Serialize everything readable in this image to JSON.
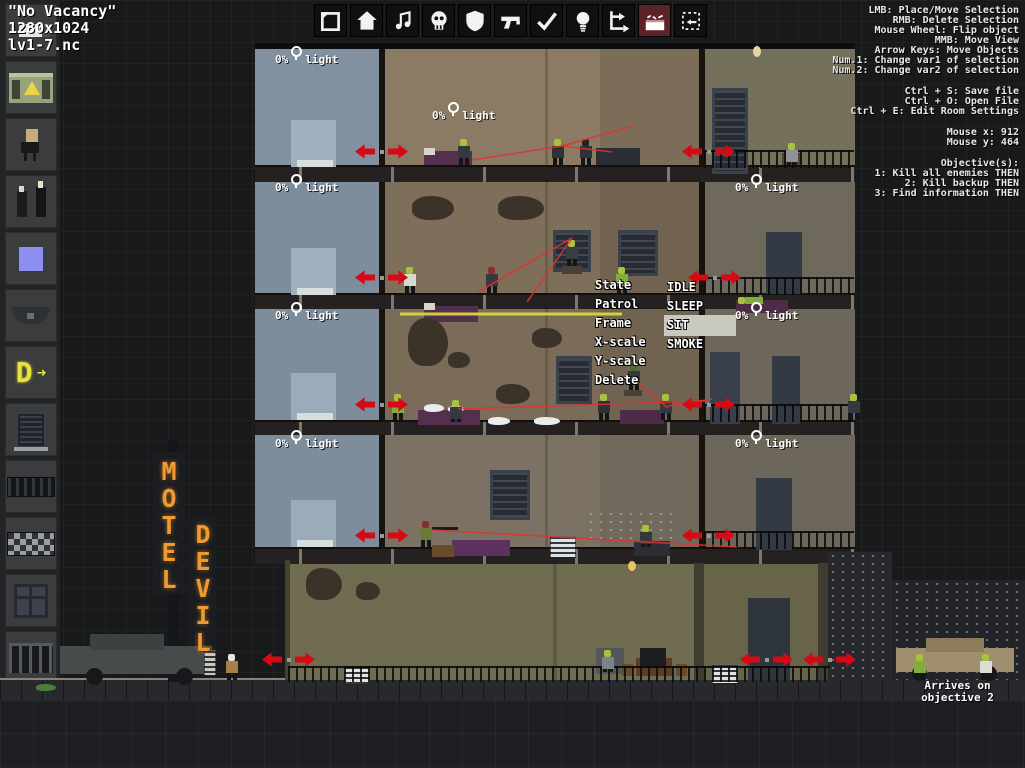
{
  "window": {
    "level_name": "\"No Vacancy\"",
    "resolution": "1280x1024",
    "filename": "lv1-7.nc"
  },
  "toolbar": {
    "selected_index": 9,
    "icons": [
      "selection-frame-icon",
      "house-icon",
      "music-note-icon",
      "skull-icon",
      "shield-icon",
      "gun-icon",
      "checkmark-icon",
      "lightbulb-icon",
      "route-icon",
      "bed-icon",
      "resize-region-icon"
    ]
  },
  "help_panel": {
    "controls": [
      "LMB: Place/Move Selection",
      "RMB: Delete Selection",
      "Mouse Wheel: Flip object",
      "MMB: Move View",
      "Arrow Keys: Move Objects",
      "Num.1: Change var1 of selection",
      "Num.2: Change var2 of selection"
    ],
    "file_commands": [
      "Ctrl + S: Save file",
      "Ctrl + O: Open File",
      "Ctrl + E: Edit Room Settings"
    ],
    "mouse_status": [
      "Mouse x: 912",
      "Mouse y: 464"
    ],
    "objectives": [
      "Objective(s):",
      "1: Kill all enemies THEN",
      "2: Kill backup THEN",
      "3: Find information THEN"
    ]
  },
  "context_menu": {
    "items": [
      "State",
      "Patrol",
      "Frame",
      "X-scale",
      "Y-scale",
      "Delete"
    ],
    "state_options": [
      "IDLE",
      "SLEEP",
      "SIT",
      "SMOKE"
    ],
    "highlighted_option": "SIT"
  },
  "sidebar": {
    "items": [
      "radiator-icon",
      "generator-icon",
      "enemy-figure-icon",
      "enemy-pair-icon",
      "blue-marker-icon",
      "awning-icon",
      "neon-letter-icon",
      "blinds-icon",
      "grill-icon",
      "checker-tiles-icon",
      "window-icon",
      "railing-icon",
      "planter-icon"
    ]
  },
  "sign": {
    "top_word": "MOTEL",
    "bottom_word": "DEVIL",
    "color": "#ef9a2e"
  },
  "street": {
    "arrival_note_line1": "Arrives on",
    "arrival_note_line2": "objective 2"
  },
  "light_label_text": "0% light",
  "colors": {
    "arrow_red": "#d60a14",
    "sight_red": "#e13232",
    "patrol_yellow": "#d8d838",
    "enemy_green": "#a6c23e",
    "neon_orange": "#ef9a2e",
    "toolbar_selected_bg": "#5b2327"
  },
  "scene": {
    "light_labels": [
      {
        "x": 275,
        "y": 46
      },
      {
        "x": 432,
        "y": 102
      },
      {
        "x": 275,
        "y": 174
      },
      {
        "x": 735,
        "y": 174
      },
      {
        "x": 275,
        "y": 302
      },
      {
        "x": 735,
        "y": 302
      },
      {
        "x": 275,
        "y": 430
      },
      {
        "x": 735,
        "y": 430
      }
    ],
    "door_arrow_pairs": [
      {
        "x": 355,
        "y": 143
      },
      {
        "x": 682,
        "y": 143
      },
      {
        "x": 355,
        "y": 269
      },
      {
        "x": 688,
        "y": 269
      },
      {
        "x": 355,
        "y": 396
      },
      {
        "x": 682,
        "y": 396
      },
      {
        "x": 355,
        "y": 527
      },
      {
        "x": 682,
        "y": 527
      },
      {
        "x": 262,
        "y": 651
      },
      {
        "x": 740,
        "y": 651
      },
      {
        "x": 803,
        "y": 651
      }
    ],
    "sight_lines": [
      [
        472,
        160,
        562,
        146
      ],
      [
        562,
        146,
        634,
        126
      ],
      [
        562,
        146,
        612,
        152
      ],
      [
        572,
        238,
        478,
        292
      ],
      [
        572,
        238,
        527,
        302
      ],
      [
        458,
        409,
        706,
        401
      ],
      [
        637,
        382,
        668,
        408
      ],
      [
        668,
        406,
        712,
        399
      ],
      [
        432,
        530,
        737,
        547
      ]
    ],
    "patrol_lines": [
      [
        400,
        314,
        622,
        314
      ]
    ],
    "enemies": [
      {
        "x": 458,
        "y": 139,
        "head": "#a6c23e",
        "body": "#34373b"
      },
      {
        "x": 552,
        "y": 139,
        "head": "#a6c23e",
        "body": "#2e3135"
      },
      {
        "x": 580,
        "y": 139,
        "head": "#1f2124",
        "body": "#2e3135"
      },
      {
        "x": 786,
        "y": 143,
        "head": "#a6c23e",
        "body": "#8d9298",
        "pose": "sit"
      },
      {
        "x": 404,
        "y": 267,
        "head": "#a6c23e",
        "body": "#d9d9d4"
      },
      {
        "x": 486,
        "y": 267,
        "head": "#8a2d2d",
        "body": "#35383c"
      },
      {
        "x": 566,
        "y": 240,
        "head": "#a6c23e",
        "body": "#3a3d41"
      },
      {
        "x": 616,
        "y": 267,
        "head": "#a6c23e",
        "body": "#7fae3c"
      },
      {
        "x": 738,
        "y": 296,
        "head": "#a6c23e",
        "body": "#7fae3c",
        "pose": "lie"
      },
      {
        "x": 392,
        "y": 394,
        "head": "#a6c23e",
        "body": "#7fae3c"
      },
      {
        "x": 450,
        "y": 400,
        "head": "#a6c23e",
        "body": "#35383c",
        "pose": "sit"
      },
      {
        "x": 598,
        "y": 394,
        "head": "#a6c23e",
        "body": "#2e3135"
      },
      {
        "x": 660,
        "y": 394,
        "head": "#a6c23e",
        "body": "#35383c"
      },
      {
        "x": 628,
        "y": 364,
        "head": "#4e6b2e",
        "body": "#35383c"
      },
      {
        "x": 848,
        "y": 394,
        "head": "#a6c23e",
        "body": "#35383c"
      },
      {
        "x": 420,
        "y": 521,
        "head": "#8a2d2d",
        "body": "#6b7a3a"
      },
      {
        "x": 640,
        "y": 525,
        "head": "#a6c23e",
        "body": "#34373b",
        "pose": "sit"
      },
      {
        "x": 602,
        "y": 650,
        "head": "#a6c23e",
        "body": "#7d8286",
        "pose": "sit"
      },
      {
        "x": 226,
        "y": 654,
        "head": "#e8e5dc",
        "body": "#a87e46"
      },
      {
        "x": 914,
        "y": 654,
        "head": "#a6c23e",
        "body": "#7fae3c"
      },
      {
        "x": 980,
        "y": 654,
        "head": "#a6c23e",
        "body": "#dcdcd6"
      }
    ],
    "props": [
      {
        "n": "roof-edge",
        "x": 255,
        "y": 43,
        "w": 600,
        "h": 6,
        "c": "#0c0d0e"
      },
      {
        "n": "room-seam",
        "x": 545,
        "y": 48,
        "w": 3,
        "h": 117,
        "c": "rgba(0,0,0,0.16)"
      },
      {
        "n": "room-shade",
        "x": 600,
        "y": 48,
        "w": 100,
        "h": 117,
        "c": "rgba(0,0,0,0.10)"
      },
      {
        "n": "room-seam",
        "x": 545,
        "y": 180,
        "w": 3,
        "h": 113,
        "c": "rgba(0,0,0,0.16)"
      },
      {
        "n": "room-shade",
        "x": 600,
        "y": 180,
        "w": 100,
        "h": 113,
        "c": "rgba(0,0,0,0.10)"
      },
      {
        "n": "room-seam",
        "x": 545,
        "y": 307,
        "w": 3,
        "h": 113,
        "c": "rgba(0,0,0,0.16)"
      },
      {
        "n": "room-shade",
        "x": 600,
        "y": 307,
        "w": 100,
        "h": 113,
        "c": "rgba(0,0,0,0.08)"
      },
      {
        "n": "room-seam",
        "x": 545,
        "y": 433,
        "w": 3,
        "h": 114,
        "c": "rgba(0,0,0,0.16)"
      },
      {
        "n": "room-shade",
        "x": 600,
        "y": 433,
        "w": 100,
        "h": 114,
        "c": "rgba(0,0,0,0.08)"
      },
      {
        "n": "ground-seam",
        "x": 553,
        "y": 562,
        "w": 4,
        "h": 118,
        "c": "rgba(0,0,0,0.15)"
      },
      {
        "n": "ground-left-wall",
        "x": 285,
        "y": 560,
        "w": 5,
        "h": 120,
        "c": "#45422f"
      },
      {
        "n": "elevator-panel",
        "x": 291,
        "y": 120,
        "w": 45,
        "h": 47,
        "c": "#9fb0bf"
      },
      {
        "n": "elevator-sill",
        "x": 297,
        "y": 160,
        "w": 36,
        "h": 7,
        "c": "#d8ddde"
      },
      {
        "n": "elevator-panel",
        "x": 291,
        "y": 248,
        "w": 45,
        "h": 47,
        "c": "#9fb0bf"
      },
      {
        "n": "elevator-sill",
        "x": 297,
        "y": 288,
        "w": 36,
        "h": 7,
        "c": "#d8ddde"
      },
      {
        "n": "elevator-panel",
        "x": 291,
        "y": 373,
        "w": 45,
        "h": 47,
        "c": "#9aabba"
      },
      {
        "n": "elevator-sill",
        "x": 297,
        "y": 413,
        "w": 36,
        "h": 7,
        "c": "#d8ddde"
      },
      {
        "n": "elevator-panel",
        "x": 291,
        "y": 500,
        "w": 45,
        "h": 47,
        "c": "#9aabba"
      },
      {
        "n": "elevator-sill",
        "x": 297,
        "y": 540,
        "w": 36,
        "h": 7,
        "c": "#d8ddde"
      },
      {
        "n": "bed",
        "x": 424,
        "y": 151,
        "w": 48,
        "h": 14,
        "c": "#55304e"
      },
      {
        "n": "pillow",
        "x": 424,
        "y": 148,
        "w": 11,
        "h": 7,
        "c": "#d8d4c8"
      },
      {
        "n": "desk",
        "x": 596,
        "y": 148,
        "w": 44,
        "h": 17,
        "c": "#2b2e34"
      },
      {
        "n": "dark-window",
        "x": 712,
        "y": 88,
        "w": 30,
        "h": 80,
        "c": "#272b33",
        "cls": "window"
      },
      {
        "n": "chair",
        "x": 782,
        "y": 153,
        "w": 20,
        "h": 12,
        "c": "#5b3d28"
      },
      {
        "n": "wall-hole",
        "x": 412,
        "y": 196,
        "w": 42,
        "h": 24,
        "c": "#3b332a",
        "cls": "hole"
      },
      {
        "n": "wall-hole",
        "x": 498,
        "y": 196,
        "w": 46,
        "h": 24,
        "c": "#3b332a",
        "cls": "hole"
      },
      {
        "n": "dark-window",
        "x": 553,
        "y": 230,
        "w": 32,
        "h": 36,
        "c": "#272b33",
        "cls": "window"
      },
      {
        "n": "dark-window",
        "x": 618,
        "y": 230,
        "w": 34,
        "h": 40,
        "c": "#272b33",
        "cls": "window"
      },
      {
        "n": "bed",
        "x": 424,
        "y": 306,
        "w": 54,
        "h": 16,
        "c": "#55304e"
      },
      {
        "n": "pillow",
        "x": 424,
        "y": 303,
        "w": 11,
        "h": 7,
        "c": "#d8d4c8"
      },
      {
        "n": "ledge-box",
        "x": 562,
        "y": 266,
        "w": 20,
        "h": 8,
        "c": "#4a4038"
      },
      {
        "n": "door",
        "x": 766,
        "y": 232,
        "w": 36,
        "h": 62,
        "c": "#333a44"
      },
      {
        "n": "bed",
        "x": 736,
        "y": 300,
        "w": 52,
        "h": 13,
        "c": "#4e2b46"
      },
      {
        "n": "wall-hole",
        "x": 408,
        "y": 318,
        "w": 40,
        "h": 48,
        "c": "#3b332a",
        "cls": "hole"
      },
      {
        "n": "wall-hole",
        "x": 448,
        "y": 352,
        "w": 22,
        "h": 16,
        "c": "#3b332a",
        "cls": "hole"
      },
      {
        "n": "wall-hole",
        "x": 532,
        "y": 328,
        "w": 30,
        "h": 20,
        "c": "#3b332a",
        "cls": "hole"
      },
      {
        "n": "wall-hole",
        "x": 560,
        "y": 360,
        "w": 24,
        "h": 16,
        "c": "#3b332a",
        "cls": "hole"
      },
      {
        "n": "wall-hole",
        "x": 496,
        "y": 384,
        "w": 34,
        "h": 20,
        "c": "#3b332a",
        "cls": "hole"
      },
      {
        "n": "dark-window",
        "x": 556,
        "y": 356,
        "w": 30,
        "h": 42,
        "c": "#272b33",
        "cls": "window"
      },
      {
        "n": "bed",
        "x": 418,
        "y": 410,
        "w": 62,
        "h": 15,
        "c": "#55304e"
      },
      {
        "n": "powder-pile",
        "x": 424,
        "y": 404,
        "w": 20,
        "h": 8,
        "c": "#e8ecee",
        "cls": "hole"
      },
      {
        "n": "powder-pile",
        "x": 448,
        "y": 406,
        "w": 16,
        "h": 6,
        "c": "#e8ecee",
        "cls": "hole"
      },
      {
        "n": "powder-pile",
        "x": 488,
        "y": 417,
        "w": 22,
        "h": 8,
        "c": "#e8ecee",
        "cls": "hole"
      },
      {
        "n": "powder-pile",
        "x": 534,
        "y": 417,
        "w": 26,
        "h": 8,
        "c": "#e8ecee",
        "cls": "hole"
      },
      {
        "n": "ledge-box",
        "x": 624,
        "y": 390,
        "w": 18,
        "h": 6,
        "c": "#4a4038"
      },
      {
        "n": "bed",
        "x": 620,
        "y": 410,
        "w": 44,
        "h": 14,
        "c": "#4e2b46"
      },
      {
        "n": "door",
        "x": 710,
        "y": 352,
        "w": 30,
        "h": 72,
        "c": "#39404c"
      },
      {
        "n": "door",
        "x": 772,
        "y": 356,
        "w": 28,
        "h": 68,
        "c": "#333a44"
      },
      {
        "n": "dark-window",
        "x": 490,
        "y": 470,
        "w": 34,
        "h": 44,
        "c": "#272b33",
        "cls": "window"
      },
      {
        "n": "couch",
        "x": 452,
        "y": 540,
        "w": 58,
        "h": 16,
        "c": "#5c3160"
      },
      {
        "n": "table",
        "x": 432,
        "y": 545,
        "w": 22,
        "h": 12,
        "c": "#6b4a2a"
      },
      {
        "n": "ac-unit",
        "x": 550,
        "y": 536,
        "w": 24,
        "h": 20,
        "c": "#dfe2e4",
        "cls": "grill"
      },
      {
        "n": "rifle",
        "x": 432,
        "y": 527,
        "w": 26,
        "h": 3,
        "c": "#191b1d"
      },
      {
        "n": "desk",
        "x": 634,
        "y": 541,
        "w": 36,
        "h": 15,
        "c": "#2b2e34"
      },
      {
        "n": "bullet-holes",
        "x": 586,
        "y": 510,
        "w": 88,
        "h": 34,
        "c": "transparent",
        "cls": "dots"
      },
      {
        "n": "door",
        "x": 756,
        "y": 478,
        "w": 36,
        "h": 72,
        "c": "#333a44"
      },
      {
        "n": "wall-hole",
        "x": 306,
        "y": 568,
        "w": 36,
        "h": 32,
        "c": "#3b332a",
        "cls": "hole"
      },
      {
        "n": "wall-hole",
        "x": 356,
        "y": 582,
        "w": 24,
        "h": 18,
        "c": "#3b332a",
        "cls": "hole"
      },
      {
        "n": "pillar",
        "x": 694,
        "y": 563,
        "w": 10,
        "h": 117,
        "c": "#3f3d2f"
      },
      {
        "n": "pillar",
        "x": 818,
        "y": 563,
        "w": 12,
        "h": 117,
        "c": "#3f3d2f"
      },
      {
        "n": "door",
        "x": 748,
        "y": 598,
        "w": 42,
        "h": 82,
        "c": "#2f353d"
      },
      {
        "n": "vent",
        "x": 344,
        "y": 666,
        "w": 24,
        "h": 17,
        "c": "#e2e4e4",
        "cls": "grill"
      },
      {
        "n": "vent",
        "x": 712,
        "y": 664,
        "w": 24,
        "h": 18,
        "c": "#e2e4e4",
        "cls": "grill"
      },
      {
        "n": "armchair",
        "x": 596,
        "y": 648,
        "w": 28,
        "h": 26,
        "c": "#53565a"
      },
      {
        "n": "tv-table",
        "x": 636,
        "y": 658,
        "w": 36,
        "h": 18,
        "c": "#5b3d28"
      },
      {
        "n": "tv",
        "x": 640,
        "y": 648,
        "w": 26,
        "h": 18,
        "c": "#1c1e22"
      },
      {
        "n": "stool",
        "x": 622,
        "y": 664,
        "w": 11,
        "h": 12,
        "c": "#6b4a2a"
      },
      {
        "n": "stool",
        "x": 676,
        "y": 664,
        "w": 11,
        "h": 12,
        "c": "#6b4a2a"
      },
      {
        "n": "hanging-lamp-cord",
        "x": 756,
        "y": 40,
        "w": 2,
        "h": 8,
        "c": "#222"
      },
      {
        "n": "hanging-lamp",
        "x": 753,
        "y": 46,
        "w": 8,
        "h": 11,
        "c": "#e7d6a2",
        "cls": "circle"
      },
      {
        "n": "hanging-lamp",
        "x": 628,
        "y": 561,
        "w": 8,
        "h": 10,
        "c": "#e7c464",
        "cls": "circle"
      },
      {
        "n": "neon-pole",
        "x": 168,
        "y": 440,
        "w": 10,
        "h": 242,
        "c": "#14161a"
      },
      {
        "n": "sign-board",
        "x": 153,
        "y": 452,
        "w": 32,
        "h": 142,
        "c": "#1b1d21"
      },
      {
        "n": "sign-board",
        "x": 187,
        "y": 516,
        "w": 30,
        "h": 142,
        "c": "#1b1d21"
      },
      {
        "n": "limo-body",
        "x": 60,
        "y": 646,
        "w": 152,
        "h": 28,
        "c": "#464b4b"
      },
      {
        "n": "limo-roof",
        "x": 90,
        "y": 634,
        "w": 74,
        "h": 16,
        "c": "#3c4141"
      },
      {
        "n": "limo-grille",
        "x": 204,
        "y": 650,
        "w": 10,
        "h": 24,
        "c": "#c9c9c2",
        "cls": "grill"
      },
      {
        "n": "limo-wheel",
        "x": 86,
        "y": 668,
        "w": 17,
        "h": 17,
        "c": "#17181a",
        "cls": "circle"
      },
      {
        "n": "limo-wheel",
        "x": 176,
        "y": 668,
        "w": 17,
        "h": 17,
        "c": "#17181a",
        "cls": "circle"
      },
      {
        "n": "city-building",
        "x": 828,
        "y": 552,
        "w": 64,
        "h": 128,
        "c": "#26282d",
        "cls": "dots"
      },
      {
        "n": "city-building",
        "x": 892,
        "y": 580,
        "w": 133,
        "h": 100,
        "c": "#222429",
        "cls": "dots"
      },
      {
        "n": "car-body",
        "x": 896,
        "y": 648,
        "w": 118,
        "h": 24,
        "c": "#a08f6e"
      },
      {
        "n": "car-roof",
        "x": 926,
        "y": 638,
        "w": 58,
        "h": 14,
        "c": "#8c7c5c"
      },
      {
        "n": "car-wheel",
        "x": 912,
        "y": 666,
        "w": 15,
        "h": 15,
        "c": "#17181a",
        "cls": "circle"
      },
      {
        "n": "car-wheel",
        "x": 982,
        "y": 666,
        "w": 15,
        "h": 15,
        "c": "#17181a",
        "cls": "circle"
      },
      {
        "n": "grass",
        "x": 36,
        "y": 684,
        "w": 20,
        "h": 7,
        "c": "#4e7c3c",
        "cls": "hole"
      },
      {
        "n": "railing",
        "x": 704,
        "y": 150,
        "w": 150,
        "h": 16,
        "c": "",
        "cls": "railing"
      },
      {
        "n": "railing",
        "x": 704,
        "y": 277,
        "w": 150,
        "h": 16,
        "c": "",
        "cls": "railing"
      },
      {
        "n": "railing",
        "x": 704,
        "y": 404,
        "w": 150,
        "h": 16,
        "c": "",
        "cls": "railing"
      },
      {
        "n": "railing",
        "x": 704,
        "y": 531,
        "w": 150,
        "h": 16,
        "c": "",
        "cls": "railing"
      },
      {
        "n": "railing",
        "x": 288,
        "y": 666,
        "w": 542,
        "h": 14,
        "c": "",
        "cls": "railing"
      }
    ]
  }
}
